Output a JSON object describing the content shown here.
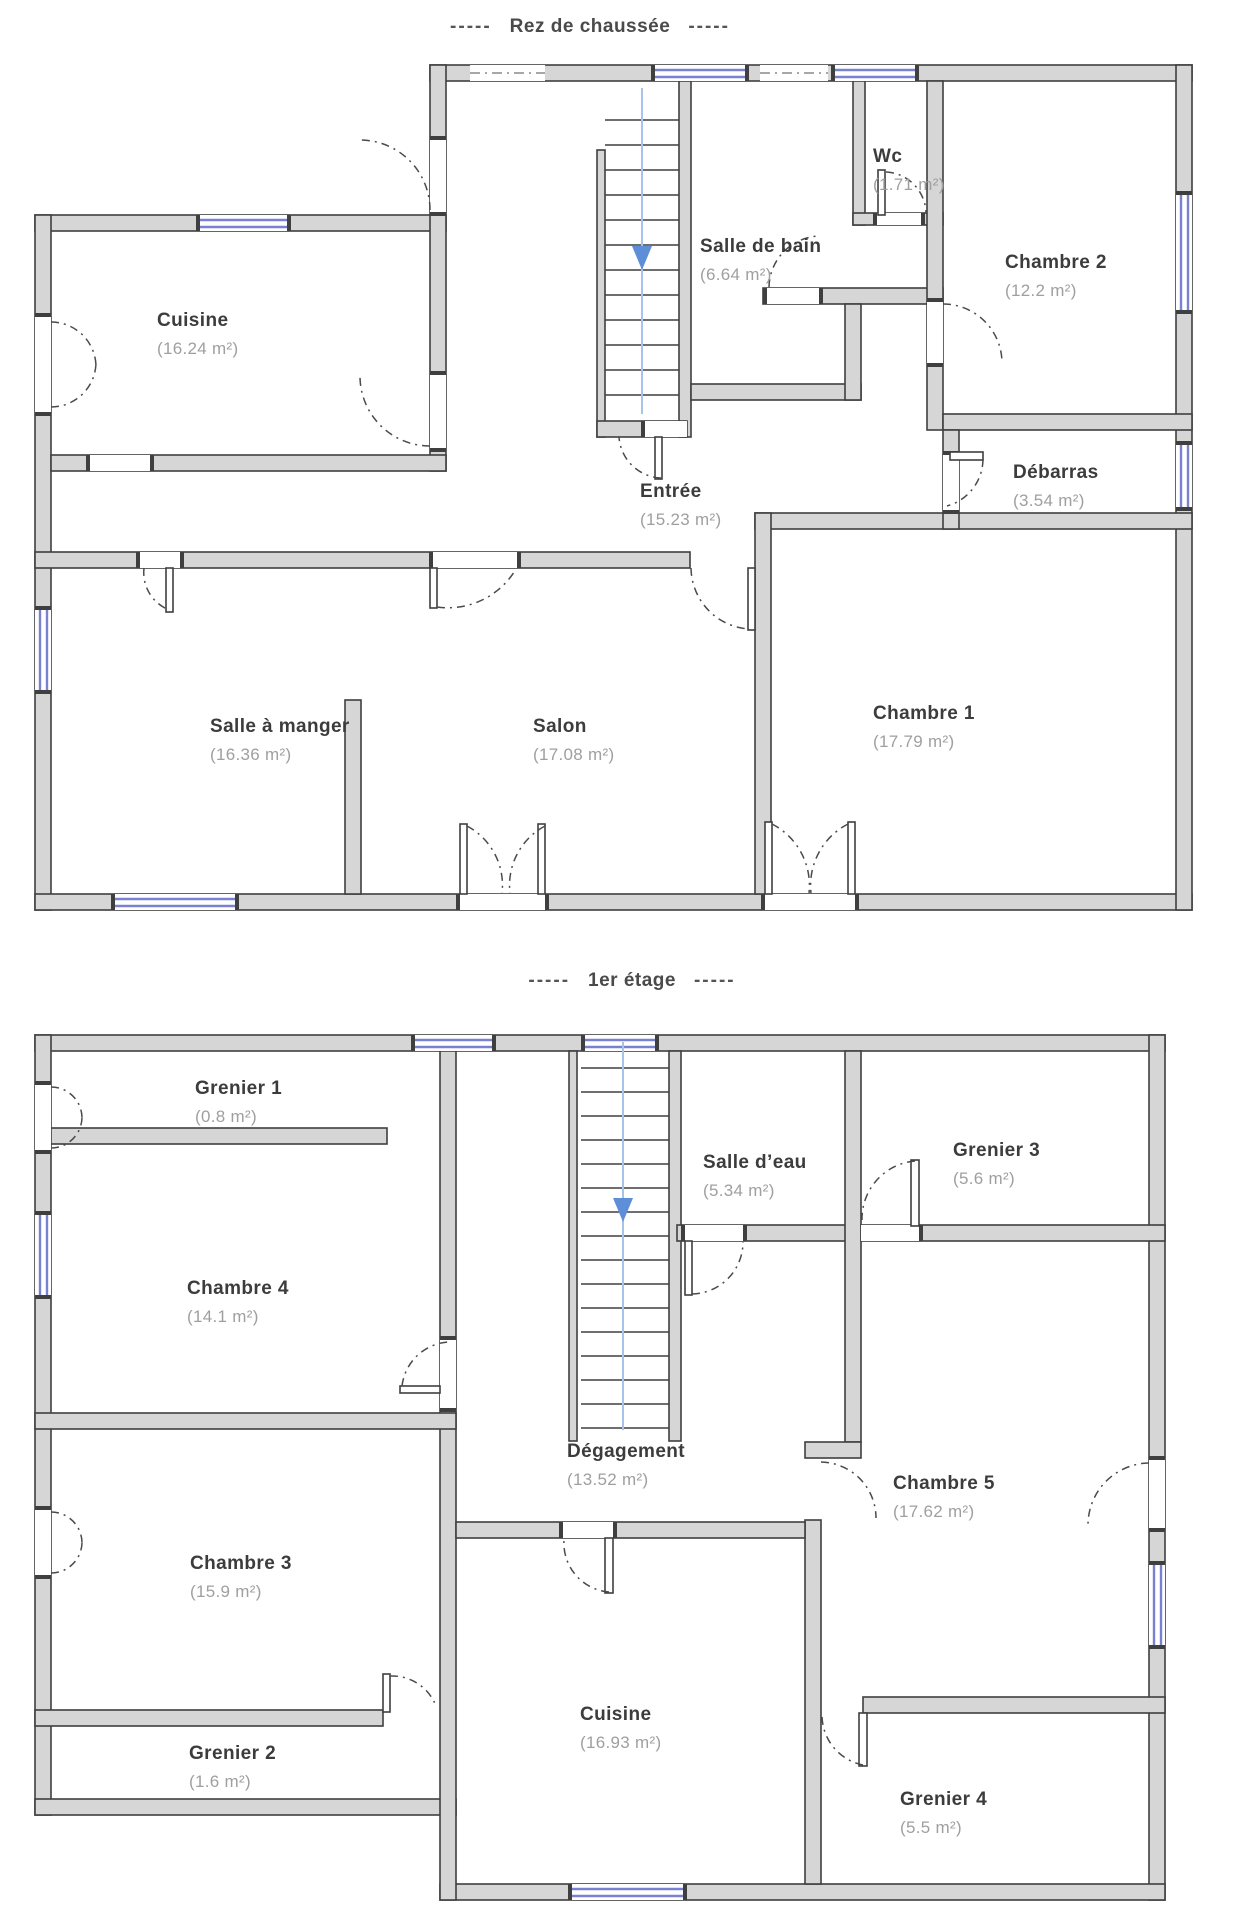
{
  "palette": {
    "wall_fill": "#d6d6d6",
    "wall_line": "#3f3f3f",
    "window_blue": "#7b81d1",
    "stair_line": "#a9c3e8",
    "stair_arrow": "#5f8ed9",
    "room_name_color": "#3c3c3c",
    "room_area_color": "#9f9f9f",
    "title_color": "#4a4a4a"
  },
  "stairs": {
    "icon": "down-arrow"
  },
  "floors": [
    {
      "id": "rez-de-chaussee",
      "title": "Rez de chaussée",
      "title_dashes": "-----",
      "rooms": [
        {
          "key": "cuisine",
          "name": "Cuisine",
          "area": "(16.24 m²)"
        },
        {
          "key": "salle-de-bain",
          "name": "Salle de bain",
          "area": "(6.64 m²)"
        },
        {
          "key": "wc",
          "name": "Wc",
          "area": "(1.71 m²)"
        },
        {
          "key": "chambre-2",
          "name": "Chambre 2",
          "area": "(12.2 m²)"
        },
        {
          "key": "entree",
          "name": "Entrée",
          "area": "(15.23 m²)"
        },
        {
          "key": "debarras",
          "name": "Débarras",
          "area": "(3.54 m²)"
        },
        {
          "key": "salle-a-manger",
          "name": "Salle à manger",
          "area": "(16.36 m²)"
        },
        {
          "key": "salon",
          "name": "Salon",
          "area": "(17.08 m²)"
        },
        {
          "key": "chambre-1",
          "name": "Chambre 1",
          "area": "(17.79 m²)"
        }
      ]
    },
    {
      "id": "premier-etage",
      "title": "1er étage",
      "title_dashes": "-----",
      "rooms": [
        {
          "key": "grenier-1",
          "name": "Grenier 1",
          "area": "(0.8 m²)"
        },
        {
          "key": "salle-d-eau",
          "name": "Salle d’eau",
          "area": "(5.34 m²)"
        },
        {
          "key": "grenier-3",
          "name": "Grenier 3",
          "area": "(5.6 m²)"
        },
        {
          "key": "chambre-4",
          "name": "Chambre 4",
          "area": "(14.1 m²)"
        },
        {
          "key": "degagement",
          "name": "Dégagement",
          "area": "(13.52 m²)"
        },
        {
          "key": "chambre-5",
          "name": "Chambre 5",
          "area": "(17.62 m²)"
        },
        {
          "key": "chambre-3",
          "name": "Chambre 3",
          "area": "(15.9 m²)"
        },
        {
          "key": "cuisine-etage",
          "name": "Cuisine",
          "area": "(16.93 m²)"
        },
        {
          "key": "grenier-2",
          "name": "Grenier 2",
          "area": "(1.6 m²)"
        },
        {
          "key": "grenier-4",
          "name": "Grenier 4",
          "area": "(5.5 m²)"
        }
      ]
    }
  ]
}
